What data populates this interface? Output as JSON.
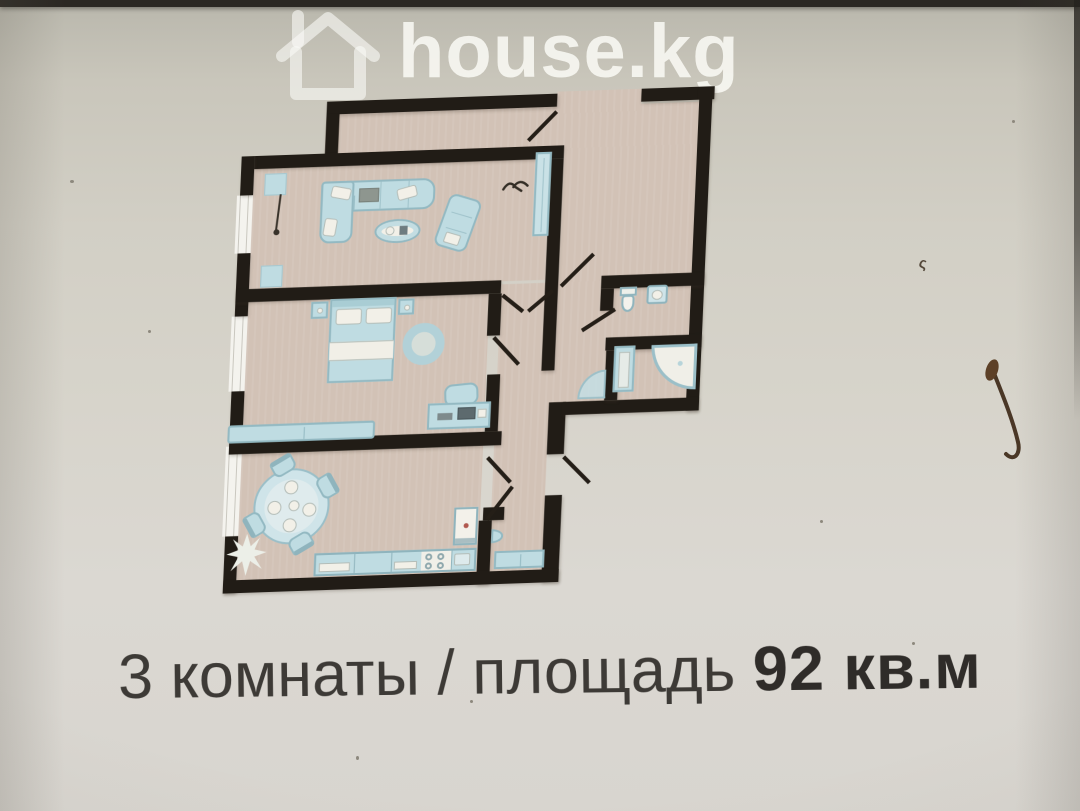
{
  "watermark": {
    "brand": "house.kg",
    "icon": "house-outline-icon",
    "color": "#fcfcf8",
    "opacity": "0.82"
  },
  "caption": {
    "prefix": "3 комнаты / площадь ",
    "area": "92",
    "unit": "кв.м",
    "area_label": "92 кв.м",
    "full": "3 комнаты / площадь 92 кв.м",
    "color": "#3d3a36"
  },
  "floorplan": {
    "wall_color": "#211c16",
    "floor_color": "#d2c2b6",
    "furniture_color": "#bfdce2",
    "window_color": "#f4f3ee",
    "furniture_icons": [
      "corner-sofa-icon",
      "coffee-table-icon",
      "loveseat-icon",
      "wardrobe-icon",
      "floor-lamp-icon",
      "bird-mark-icon",
      "double-bed-icon",
      "nightstand-icon",
      "round-rug-icon",
      "bench-icon",
      "desk-icon",
      "desk-chair-icon",
      "dining-table-icon",
      "dining-chair-icon",
      "plant-icon",
      "kitchen-counter-icon",
      "stove-icon",
      "sink-icon",
      "fridge-icon",
      "hall-cabinet-icon",
      "toilet-icon",
      "washbasin-icon",
      "shower-cabin-icon",
      "bath-cabinet-icon",
      "door-swing-icon",
      "window-icon"
    ]
  },
  "photo": {
    "background": "#d7d4cb",
    "top_strip": "#2b2823",
    "stain_color": "#4a3726"
  }
}
